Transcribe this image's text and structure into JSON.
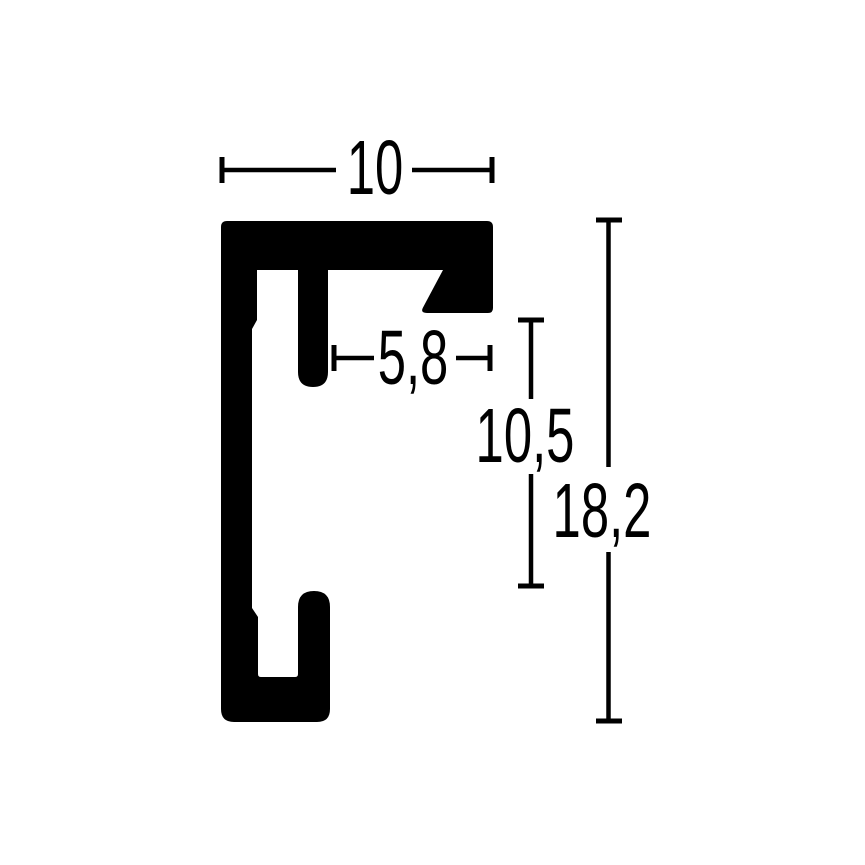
{
  "diagram": {
    "type": "technical-drawing",
    "subject": "frame-profile-cross-section",
    "colors": {
      "ink": "#000000",
      "background": "#ffffff"
    },
    "dimensions": {
      "profile_width": {
        "label": "10"
      },
      "rabbet_opening": {
        "label": "5,8"
      },
      "inner_height": {
        "label": "10,5"
      },
      "total_height": {
        "label": "18,2"
      }
    }
  }
}
